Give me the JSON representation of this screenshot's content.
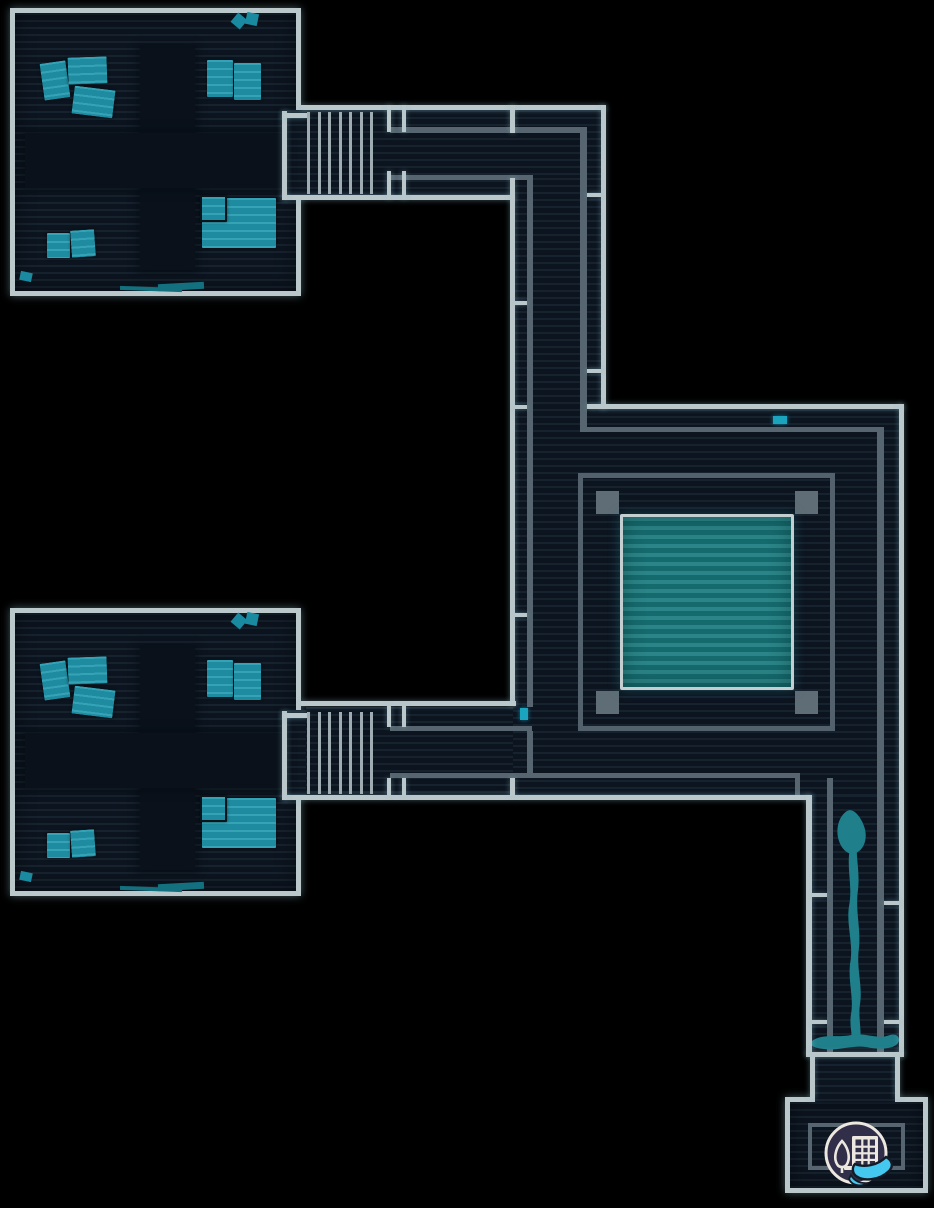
{
  "canvas": {
    "width": 934,
    "height": 1208,
    "scene": "facility-floor-map"
  },
  "colors": {
    "background": "#000000",
    "floor": "#0c141f",
    "floor_line": "#16222e",
    "zone_dark": "#0a111b",
    "wall_bright": "#bac7cb",
    "wall_dark": "#566570",
    "stair_bar": "#9fadb3",
    "desk": "#1e8ba0",
    "desk_stripe": "#35a3b5",
    "prop": "#1a8aa0",
    "prop_dim": "#13707f",
    "pillar": "#5f6d76",
    "frame": "#52616c",
    "pool": "#156a6d",
    "pool_stripe": "#2b8487",
    "pool_border": "#c3ced1",
    "marker": "#1ba4bd",
    "stream": "#1f7f8b",
    "badge_bg": "#302e49",
    "badge_ring": "#ece7df",
    "badge_cyan": "#45c8f0"
  },
  "map": {
    "room_offsets": [
      {
        "x": 10,
        "y": 8
      },
      {
        "x": 10,
        "y": 608
      }
    ],
    "layers": [
      {
        "name": "room",
        "cls": "room",
        "parent": "low",
        "items": [
          {
            "name": "office-room-northwest",
            "x": 10,
            "y": 8,
            "w": 291,
            "h": 288
          },
          {
            "name": "office-room-southwest",
            "x": 10,
            "y": 608,
            "w": 291,
            "h": 288
          },
          {
            "name": "entrance-room-southeast",
            "x": 785,
            "y": 1097,
            "w": 143,
            "h": 96
          }
        ]
      },
      {
        "name": "floor",
        "cls": "fill",
        "parent": "low",
        "items": [
          {
            "name": "stairs-landing-north",
            "x": 287,
            "y": 110,
            "w": 103,
            "h": 85
          },
          {
            "name": "corridor-north-floor",
            "x": 306,
            "y": 110,
            "w": 295,
            "h": 85
          },
          {
            "name": "corridor-vertical-floor",
            "x": 513,
            "y": 178,
            "w": 88,
            "h": 231
          },
          {
            "name": "hall-floor",
            "x": 513,
            "y": 409,
            "w": 386,
            "h": 386
          },
          {
            "name": "stairs-landing-south",
            "x": 287,
            "y": 710,
            "w": 103,
            "h": 85
          },
          {
            "name": "corridor-south-floor",
            "x": 306,
            "y": 707,
            "w": 207,
            "h": 88
          },
          {
            "name": "corridor-east-floor",
            "x": 812,
            "y": 795,
            "w": 87,
            "h": 257
          },
          {
            "name": "entrance-passage-floor",
            "x": 815,
            "y": 1057,
            "w": 80,
            "h": 45
          }
        ]
      },
      {
        "name": "furniture",
        "parent": "low",
        "per_room": true,
        "items": [
          {
            "name": "floor-zone-vertical",
            "cls": "zone",
            "x": 130,
            "y": 40,
            "w": 55,
            "h": 222
          },
          {
            "name": "floor-zone-horizontal",
            "cls": "zone",
            "x": 15,
            "y": 125,
            "w": 260,
            "h": 55
          },
          {
            "name": "desk",
            "cls": "desk",
            "x": 32,
            "y": 54,
            "w": 26,
            "h": 37,
            "rot": -8
          },
          {
            "name": "desk",
            "cls": "desk",
            "x": 58,
            "y": 49,
            "w": 39,
            "h": 27,
            "rot": -2
          },
          {
            "name": "desk",
            "cls": "desk",
            "x": 63,
            "y": 80,
            "w": 41,
            "h": 28,
            "rot": 7
          },
          {
            "name": "desk",
            "cls": "desk",
            "x": 197,
            "y": 52,
            "w": 26,
            "h": 37
          },
          {
            "name": "desk",
            "cls": "desk",
            "x": 224,
            "y": 55,
            "w": 27,
            "h": 37
          },
          {
            "name": "desk",
            "cls": "desk",
            "x": 192,
            "y": 190,
            "w": 74,
            "h": 50
          },
          {
            "name": "desk",
            "cls": "desk desk-outlined",
            "x": 190,
            "y": 187,
            "w": 27,
            "h": 27
          },
          {
            "name": "desk",
            "cls": "desk",
            "x": 37,
            "y": 225,
            "w": 23,
            "h": 25
          },
          {
            "name": "desk",
            "cls": "desk",
            "x": 61,
            "y": 222,
            "w": 24,
            "h": 27,
            "rot": -4
          },
          {
            "name": "prop-chip",
            "cls": "chip",
            "x": 223,
            "y": 7,
            "w": 12,
            "h": 12,
            "rot": 40
          },
          {
            "name": "prop-chip",
            "cls": "chip",
            "x": 236,
            "y": 5,
            "w": 12,
            "h": 12,
            "rot": 12
          },
          {
            "name": "prop-chip",
            "cls": "chip",
            "x": 10,
            "y": 264,
            "w": 12,
            "h": 9,
            "rot": 12
          },
          {
            "name": "prop-sliver",
            "cls": "sliver",
            "x": 110,
            "y": 279,
            "w": 62,
            "h": 4,
            "rot": 2
          },
          {
            "name": "prop-sliver",
            "cls": "sliver",
            "x": 148,
            "y": 275,
            "w": 46,
            "h": 7,
            "rot": -3
          }
        ]
      },
      {
        "name": "courtyard",
        "parent": "low",
        "items": [
          {
            "name": "courtyard-frame",
            "cls": "frame",
            "x": 578,
            "y": 473,
            "w": 257,
            "h": 258
          },
          {
            "name": "courtyard-pillar",
            "cls": "pillar",
            "x": 596,
            "y": 491,
            "w": 23,
            "h": 23
          },
          {
            "name": "courtyard-pillar",
            "cls": "pillar",
            "x": 795,
            "y": 491,
            "w": 23,
            "h": 23
          },
          {
            "name": "courtyard-pillar",
            "cls": "pillar",
            "x": 596,
            "y": 691,
            "w": 23,
            "h": 23
          },
          {
            "name": "courtyard-pillar",
            "cls": "pillar",
            "x": 795,
            "y": 691,
            "w": 23,
            "h": 23
          },
          {
            "name": "courtyard-pool",
            "cls": "pool",
            "x": 620,
            "y": 514,
            "w": 174,
            "h": 176
          }
        ]
      },
      {
        "name": "map-marker",
        "cls": "marker",
        "parent": "low",
        "items": [
          {
            "name": "teal-marker-hall-north",
            "x": 773,
            "y": 416,
            "w": 14,
            "h": 8
          },
          {
            "name": "teal-marker-hall-west",
            "x": 520,
            "y": 708,
            "w": 8,
            "h": 12
          }
        ]
      },
      {
        "name": "wall-inner",
        "cls": "wall-dark",
        "parent": "low",
        "items": [
          {
            "x": 390,
            "y": 127,
            "w": 196,
            "h": 6
          },
          {
            "x": 580,
            "y": 127,
            "w": 7,
            "h": 305
          },
          {
            "x": 390,
            "y": 175,
            "w": 137,
            "h": 5
          },
          {
            "x": 527,
            "y": 175,
            "w": 6,
            "h": 532
          },
          {
            "x": 580,
            "y": 427,
            "w": 297,
            "h": 5
          },
          {
            "x": 877,
            "y": 427,
            "w": 7,
            "h": 625
          },
          {
            "x": 390,
            "y": 726,
            "w": 142,
            "h": 5
          },
          {
            "x": 527,
            "y": 731,
            "w": 6,
            "h": 42
          },
          {
            "x": 390,
            "y": 773,
            "w": 410,
            "h": 5
          },
          {
            "x": 795,
            "y": 773,
            "w": 5,
            "h": 25
          },
          {
            "x": 827,
            "y": 778,
            "w": 6,
            "h": 274
          },
          {
            "name": "entrance-inner-rect",
            "cls": "inner-rect",
            "x": 808,
            "y": 1123,
            "w": 97,
            "h": 47
          }
        ]
      },
      {
        "name": "wall-outer",
        "cls": "wall",
        "parent": "high",
        "items": [
          {
            "x": 301,
            "y": 105,
            "w": 305,
            "h": 5
          },
          {
            "x": 601,
            "y": 105,
            "w": 5,
            "h": 304
          },
          {
            "x": 587,
            "y": 404,
            "w": 317,
            "h": 5
          },
          {
            "x": 899,
            "y": 404,
            "w": 5,
            "h": 653
          },
          {
            "x": 282,
            "y": 195,
            "w": 233,
            "h": 5
          },
          {
            "x": 510,
            "y": 105,
            "w": 5,
            "h": 28
          },
          {
            "x": 510,
            "y": 178,
            "w": 5,
            "h": 528
          },
          {
            "x": 301,
            "y": 701,
            "w": 215,
            "h": 5
          },
          {
            "x": 282,
            "y": 795,
            "w": 530,
            "h": 5
          },
          {
            "x": 806,
            "y": 795,
            "w": 6,
            "h": 262
          },
          {
            "x": 806,
            "y": 1052,
            "w": 98,
            "h": 5
          },
          {
            "x": 810,
            "y": 1057,
            "w": 5,
            "h": 42
          },
          {
            "x": 895,
            "y": 1057,
            "w": 5,
            "h": 42
          },
          {
            "name": "stair-bracket",
            "x": 282,
            "y": 111,
            "w": 5,
            "h": 89
          },
          {
            "name": "stair-bracket",
            "x": 282,
            "y": 113,
            "w": 26,
            "h": 5
          },
          {
            "name": "stair-bracket",
            "x": 282,
            "y": 711,
            "w": 5,
            "h": 89
          },
          {
            "name": "stair-bracket",
            "x": 282,
            "y": 713,
            "w": 26,
            "h": 5
          },
          {
            "name": "door-tick",
            "x": 387,
            "y": 105,
            "w": 4,
            "h": 27
          },
          {
            "name": "door-tick",
            "x": 402,
            "y": 105,
            "w": 4,
            "h": 27
          },
          {
            "name": "door-tick",
            "x": 387,
            "y": 171,
            "w": 4,
            "h": 28
          },
          {
            "name": "door-tick",
            "x": 402,
            "y": 171,
            "w": 4,
            "h": 28
          },
          {
            "name": "door-tick",
            "x": 387,
            "y": 706,
            "w": 4,
            "h": 21
          },
          {
            "name": "door-tick",
            "x": 402,
            "y": 706,
            "w": 4,
            "h": 21
          },
          {
            "name": "door-tick",
            "x": 387,
            "y": 778,
            "w": 4,
            "h": 18
          },
          {
            "name": "door-tick",
            "x": 402,
            "y": 778,
            "w": 4,
            "h": 18
          },
          {
            "name": "door-tick",
            "x": 510,
            "y": 778,
            "w": 5,
            "h": 18
          },
          {
            "name": "lane-tick",
            "x": 515,
            "y": 301,
            "w": 12,
            "h": 4
          },
          {
            "name": "lane-tick",
            "x": 515,
            "y": 405,
            "w": 12,
            "h": 4
          },
          {
            "name": "lane-tick",
            "x": 515,
            "y": 613,
            "w": 12,
            "h": 4
          },
          {
            "name": "lane-tick",
            "x": 587,
            "y": 193,
            "w": 14,
            "h": 4
          },
          {
            "name": "lane-tick",
            "x": 587,
            "y": 369,
            "w": 14,
            "h": 4
          },
          {
            "name": "lane-tick",
            "x": 812,
            "y": 893,
            "w": 15,
            "h": 4
          },
          {
            "name": "lane-tick",
            "x": 884,
            "y": 901,
            "w": 15,
            "h": 4
          },
          {
            "name": "lane-tick",
            "x": 812,
            "y": 1020,
            "w": 15,
            "h": 4
          },
          {
            "name": "lane-tick",
            "x": 884,
            "y": 1020,
            "w": 15,
            "h": 4
          }
        ]
      },
      {
        "name": "stair-bar",
        "cls": "bar",
        "parent": "high",
        "items": [
          {
            "x": 307,
            "y": 112,
            "w": 3,
            "h": 82,
            "repeat": {
              "count": 7,
              "step": 10.5
            }
          },
          {
            "x": 307,
            "y": 712,
            "w": 3,
            "h": 82,
            "repeat": {
              "count": 7,
              "step": 10.5
            }
          }
        ]
      }
    ],
    "water_leak": {
      "name": "water-leak-stream"
    },
    "badge": {
      "name": "facility-location-badge",
      "glyphs": [
        "building-icon",
        "tree-icon",
        "hand-swoosh-icon"
      ]
    }
  }
}
